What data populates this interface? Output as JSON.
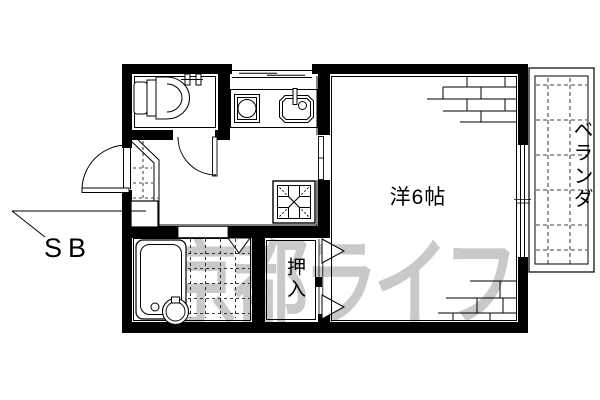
{
  "floorplan": {
    "rooms": {
      "main_room_label": "洋6帖",
      "closet_label": "押入",
      "veranda_label": "ベランダ",
      "shoe_box_label": "SB"
    },
    "watermark_text": "京都ライフ",
    "colors": {
      "line": "#000000",
      "background": "#ffffff",
      "watermark": "#c9c9c9"
    },
    "fixtures": [
      "toilet",
      "toilet-paper-holder",
      "kitchen-window",
      "gas-stove",
      "kitchen-sink",
      "entrance-door",
      "shoe-box",
      "floor-hatch",
      "bathtub",
      "washbasin",
      "bathroom-door",
      "closet-sliding-doors",
      "veranda-sliding-window"
    ]
  }
}
